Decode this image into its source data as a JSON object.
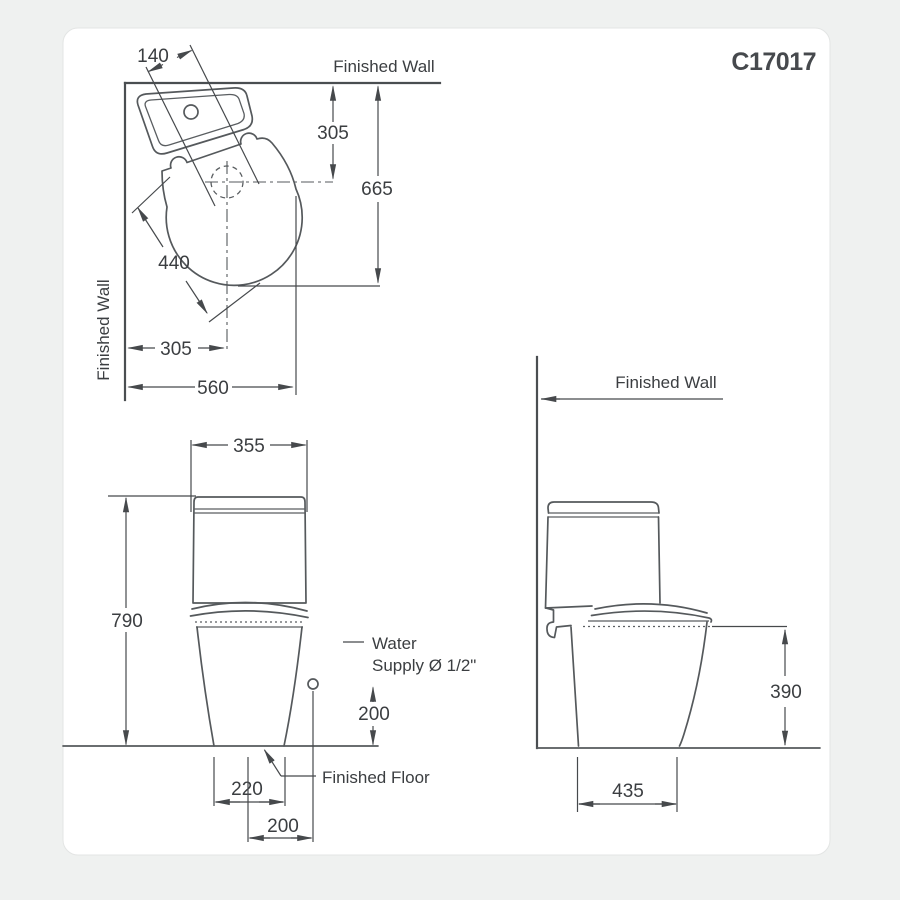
{
  "product_code": "C17017",
  "labels": {
    "finished_wall": "Finished Wall",
    "finished_floor": "Finished Floor",
    "water_supply_line1": "Water",
    "water_supply_line2": "Supply Ø 1/2\""
  },
  "plan_view": {
    "dim_tank_width": "140",
    "dim_wall_to_outlet": "305",
    "dim_overall_depth": "665",
    "dim_seat_length": "440",
    "dim_wall_to_centerline": "305",
    "dim_overall_width": "560"
  },
  "front_view": {
    "dim_tank_width": "355",
    "dim_overall_height": "790",
    "dim_outlet_width": "220",
    "dim_supply_offset": "200",
    "dim_supply_height": "200"
  },
  "side_view": {
    "dim_seat_height": "390",
    "dim_base_depth": "435"
  },
  "colors": {
    "line": "#55595c",
    "text": "#3b3e41",
    "card_background": "#ffffff",
    "page_background": "#eff1f0"
  }
}
